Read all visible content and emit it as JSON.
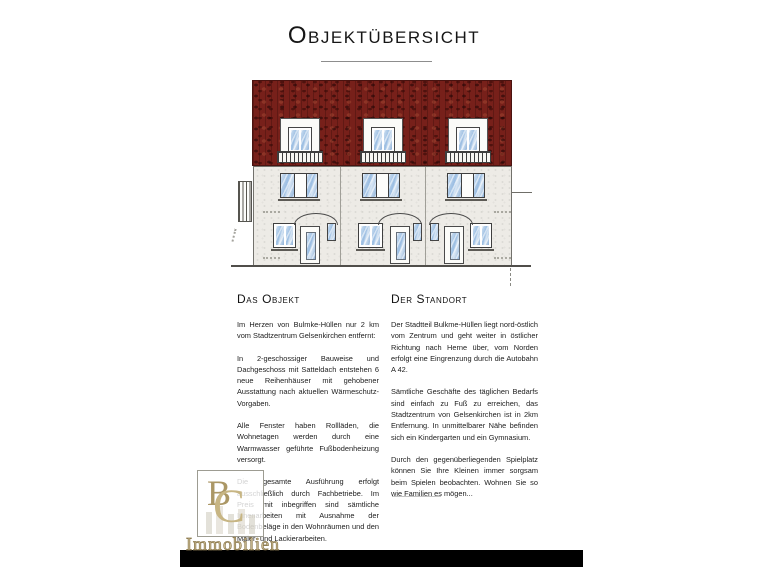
{
  "page": {
    "title": "Objektübersicht"
  },
  "sections": {
    "object": {
      "heading": "Das Objekt",
      "paragraphs": [
        "Im Herzen von Bulmke-Hüllen nur 2 km vom Stadtzentrum Gelsenkirchen entfernt:",
        "In 2-geschossiger Bauweise und Dachgeschoss mit Satteldach entstehen 6 neue Reihenhäuser mit gehobener Ausstattung nach aktuellen Wärmeschutz-Vorgaben.",
        "Alle Fenster haben Rollläden, die Wohnetagen werden durch eine Warmwasser geführte Fußbodenheizung versorgt.",
        "Die gesamte Ausführung erfolgt ausschließlich durch Fachbetriebe. Im Preis mit inbegriffen sind sämtliche Innenarbeiten mit Ausnahme der Bodenbeläge in den Wohnräumen und den Maler- und Lackierarbeiten."
      ]
    },
    "location": {
      "heading": "Der Standort",
      "paragraphs": [
        "Der Stadtteil Bulkme-Hüllen liegt nord-östlich vom Zentrum und geht weiter in östlicher Richtung nach Herne über, vom Norden erfolgt eine Eingrenzung durch die Autobahn A 42.",
        "Sämtliche Geschäfte des täglichen Bedarfs sind einfach zu Fuß zu erreichen, das Stadtzentrum von Gelsenkirchen ist in 2km Entfernung. In unmittelbarer Nähe befinden sich ein Kindergarten und ein Gymnasium.",
        "Durch den gegenüberliegenden Spielplatz können Sie Ihre Kleinen immer sorgsam beim Spielen beobachten. Wohnen Sie so wie Familien es mögen..."
      ]
    }
  },
  "drawing": {
    "type": "building-front-elevation",
    "colors": {
      "roof": "#77201a",
      "facade": "#edebe6",
      "glass": "#9abde2"
    }
  },
  "watermark": {
    "monogram_b": "B",
    "monogram_c": "C",
    "label": "Immobilien",
    "accent_gold": "#c7b583"
  }
}
